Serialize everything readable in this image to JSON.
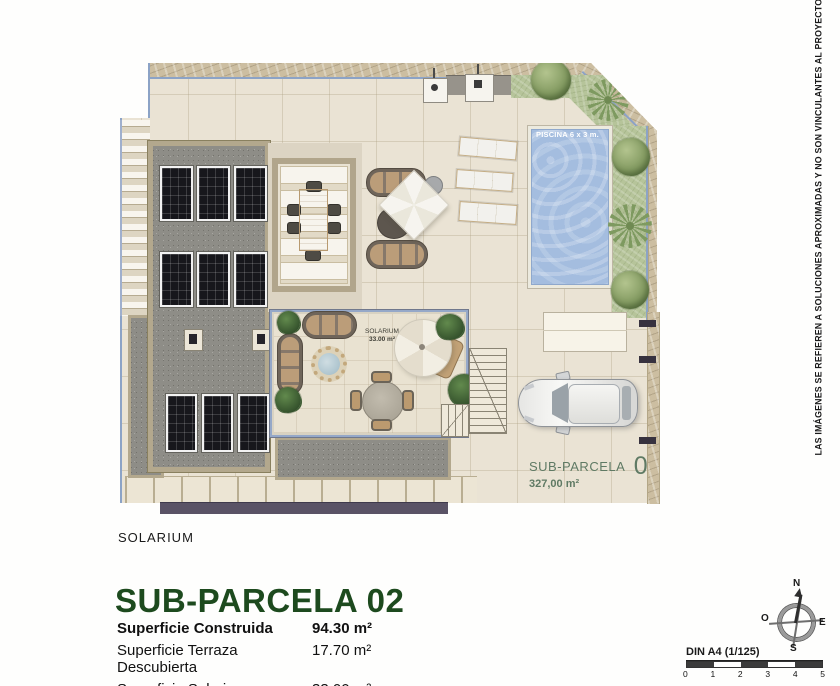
{
  "plan": {
    "pool_label": "PISCINA 6 x 3 m.",
    "solarium_tag_line1": "SOLARIUM",
    "solarium_tag_line2": "33.00 m²",
    "parcel_label": "SUB-PARCELA",
    "parcel_number": "02",
    "parcel_area": "327,00 m²"
  },
  "caption": "SOLARIUM",
  "title": "SUB-PARCELA 02",
  "area_table": {
    "rows": [
      {
        "label": "Superficie Construida",
        "value": "94.30 m²"
      },
      {
        "label": "Superficie Terraza Descubierta",
        "value": "17.70 m²"
      },
      {
        "label": "Superficie Solarium",
        "value": "33.00 m²"
      }
    ]
  },
  "disclaimer": "LAS IMÁGENES SE REFIEREN A SOLUCIONES APROXIMADAS Y NO SON VINCULANTES AL PROYECTO FINAL",
  "compass": {
    "north": "N",
    "south": "S",
    "east": "E",
    "west": "O"
  },
  "scale_bar": {
    "label": "DIN A4 (1/125)",
    "ticks": [
      "0",
      "1",
      "2",
      "3",
      "4",
      "5"
    ]
  },
  "colors": {
    "title_green": "#1d4a1e",
    "parcel_label_green": "#5f7a64",
    "pool_blue": "#a4bddf",
    "gravel_gray": "#8e8d87"
  }
}
